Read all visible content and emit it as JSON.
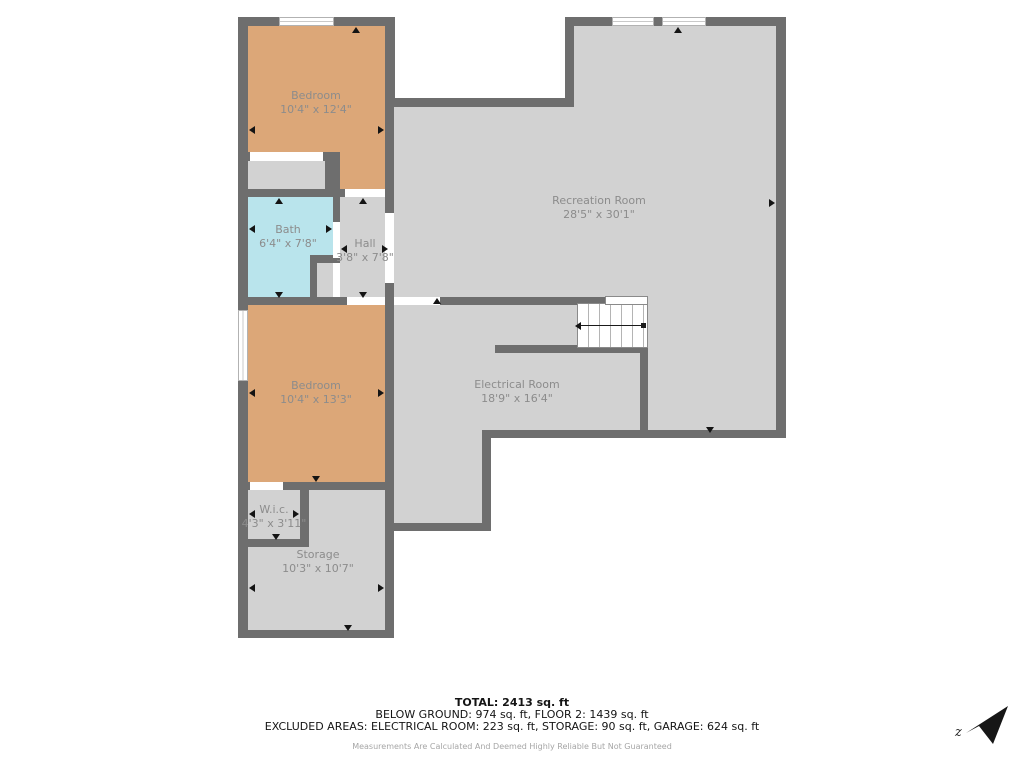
{
  "floorplan": {
    "rooms": [
      {
        "id": "bedroom-1",
        "name": "Bedroom",
        "dims": "10'4\" x 12'4\""
      },
      {
        "id": "recreation-room",
        "name": "Recreation Room",
        "dims": "28'5\" x 30'1\""
      },
      {
        "id": "bath",
        "name": "Bath",
        "dims": "6'4\" x 7'8\""
      },
      {
        "id": "hall",
        "name": "Hall",
        "dims": "3'8\" x 7'8\""
      },
      {
        "id": "electrical-room",
        "name": "Electrical Room",
        "dims": "18'9\" x 16'4\""
      },
      {
        "id": "bedroom-2",
        "name": "Bedroom",
        "dims": "10'4\" x 13'3\""
      },
      {
        "id": "wic",
        "name": "W.i.c.",
        "dims": "4'3\" x 3'11\""
      },
      {
        "id": "storage",
        "name": "Storage",
        "dims": "10'3\" x 10'7\""
      }
    ],
    "colors": {
      "wall": "#6e6e6e",
      "floor": "#d2d2d2",
      "bedroom": "#dca778",
      "bath": "#b9e4ec"
    },
    "compass_label": "z"
  },
  "summary": {
    "total": "TOTAL: 2413 sq. ft",
    "floors": "BELOW GROUND: 974 sq. ft, FLOOR 2: 1439 sq. ft",
    "excluded": "EXCLUDED AREAS: ELECTRICAL ROOM: 223 sq. ft, STORAGE: 90 sq. ft, GARAGE: 624 sq. ft",
    "disclaimer": "Measurements Are Calculated And Deemed Highly Reliable But Not Guaranteed"
  }
}
